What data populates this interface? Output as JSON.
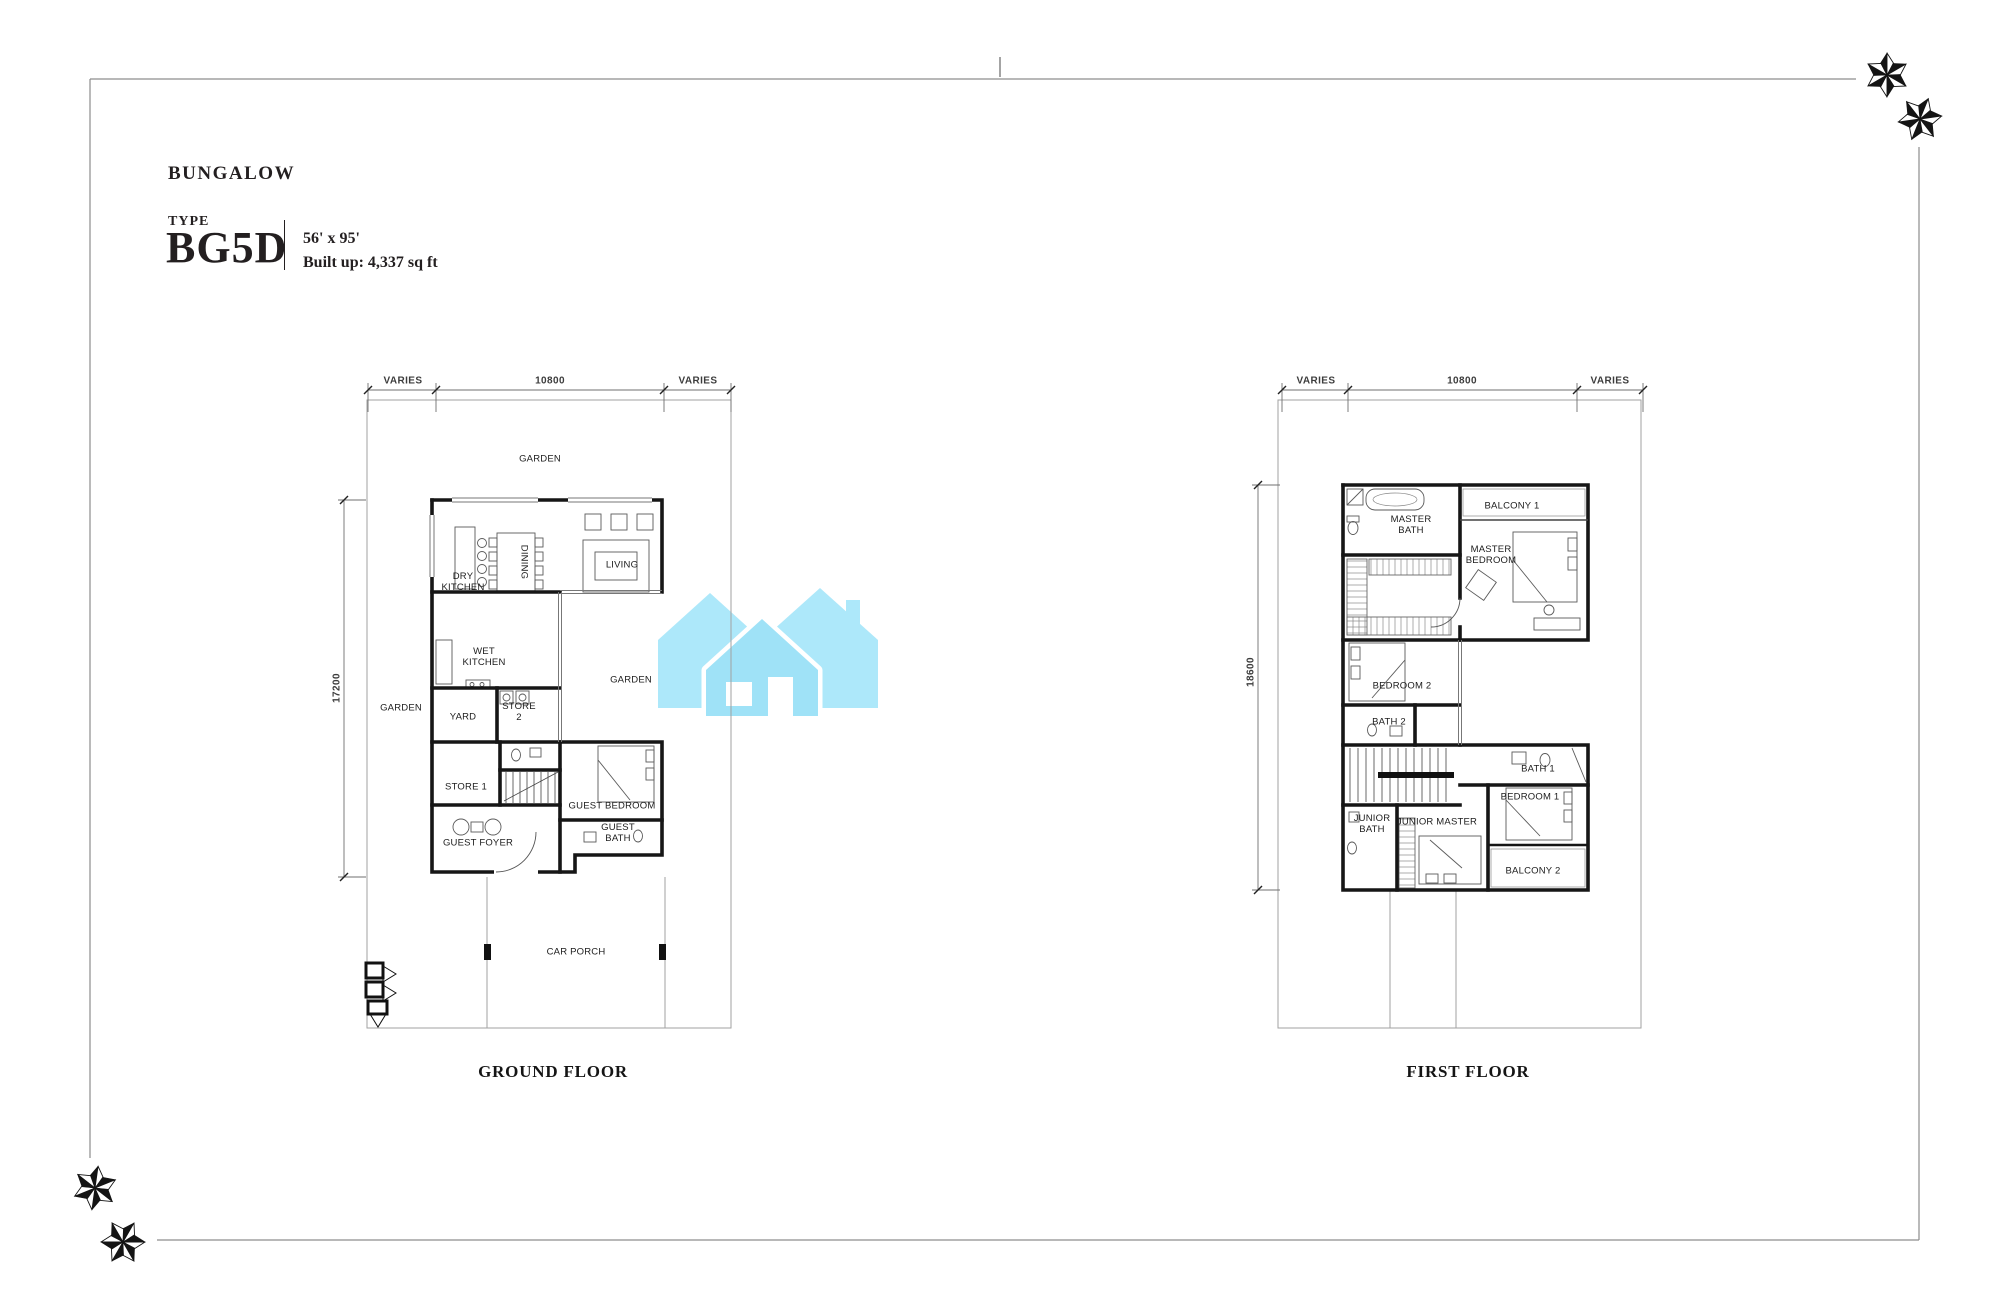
{
  "title_block": {
    "category": "BUNGALOW",
    "type_label": "TYPE",
    "type_code": "BG5D",
    "lot_size": "56' x 95'",
    "built_up": "Built up:  4,337 sq ft"
  },
  "ground_floor": {
    "name": "GROUND FLOOR",
    "dim_top_left": "VARIES",
    "dim_top_center": "10800",
    "dim_top_right": "VARIES",
    "dim_side": "17200",
    "rooms": {
      "garden_top": "GARDEN",
      "dry_kitchen": "DRY KITCHEN",
      "dining": "DINING",
      "living": "LIVING",
      "wet_kitchen": "WET KITCHEN",
      "garden_left": "GARDEN",
      "yard": "YARD",
      "store_2": "STORE 2",
      "garden_right": "GARDEN",
      "store_1": "STORE 1",
      "guest_foyer": "GUEST FOYER",
      "guest_bedroom": "GUEST BEDROOM",
      "guest_bath": "GUEST BATH",
      "car_porch": "CAR PORCH"
    }
  },
  "first_floor": {
    "name": "FIRST FLOOR",
    "dim_top_left": "VARIES",
    "dim_top_center": "10800",
    "dim_top_right": "VARIES",
    "dim_side": "18600",
    "rooms": {
      "master_bath": "MASTER BATH",
      "balcony_1": "BALCONY 1",
      "master_bedroom": "MASTER BEDROOM",
      "bedroom_2": "BEDROOM 2",
      "bath_2": "BATH 2",
      "bath_1": "BATH 1",
      "bedroom_1": "BEDROOM 1",
      "junior_bath": "JUNIOR BATH",
      "junior_master": "JUNIOR MASTER",
      "balcony_2": "BALCONY 2"
    }
  },
  "colors": {
    "logo_cyan_back": "#ade8fa",
    "logo_cyan_front": "#9fe2f7",
    "wall_black": "#161616",
    "boundary_gray": "#a2a2a2",
    "text_dark": "#231f20"
  }
}
